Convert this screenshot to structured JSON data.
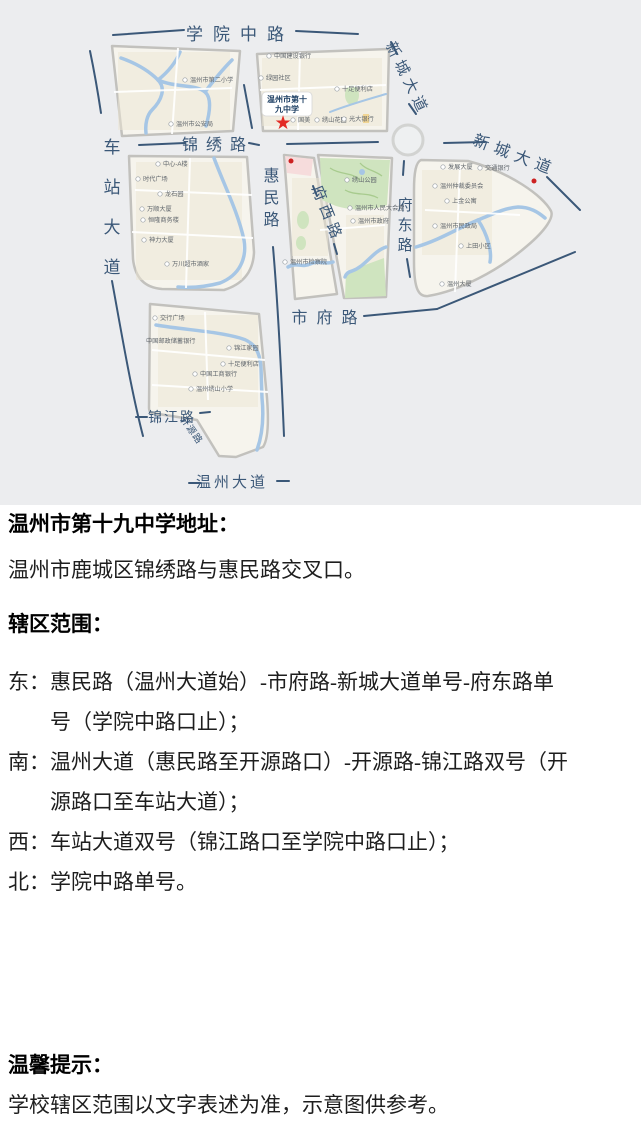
{
  "map": {
    "background": "#ecedef",
    "colors": {
      "block_fill": "#f6f4ed",
      "block_border": "#c2c1bd",
      "river": "#a6c6e5",
      "park": "#cfe4bf",
      "pink_area": "#f6dcdc",
      "road_label": "#3b5878",
      "star": "#e32a24"
    },
    "roads": {
      "xueyuan": "学院中路",
      "xincheng": "新城大道",
      "chezhan": "车站大道",
      "jinxiu": "锦绣路",
      "huimin": "惠民路",
      "fuxi": "府西路",
      "fudong": "府东路",
      "shifu": "市府路",
      "jinjiang": "锦江路",
      "kaiyuan": "开源路",
      "wenzhoudadao": "温州大道"
    },
    "school": {
      "name": "温州市第十九中学",
      "line1": "温州市第十",
      "line2": "九中学"
    },
    "pois": [
      {
        "name": "中国建设银行"
      },
      {
        "name": "绿园社区"
      },
      {
        "name": "十足便利店"
      },
      {
        "name": "国美"
      },
      {
        "name": "绣山花园"
      },
      {
        "name": "光大银行"
      },
      {
        "name": "温州市第二小学"
      },
      {
        "name": "温州市公安局"
      },
      {
        "name": "中心-A楼"
      },
      {
        "name": "时代广场"
      },
      {
        "name": "龙石园"
      },
      {
        "name": "万顺大厦"
      },
      {
        "name": "恒隆商务楼"
      },
      {
        "name": "神力大厦"
      },
      {
        "name": "万川超市酒家"
      },
      {
        "name": "温州市检察院"
      },
      {
        "name": "绣山公园"
      },
      {
        "name": "温州市人民大会堂"
      },
      {
        "name": "温州市政府"
      },
      {
        "name": "发展大厦"
      },
      {
        "name": "交通银行"
      },
      {
        "name": "温州仲裁委员会"
      },
      {
        "name": "上金公寓"
      },
      {
        "name": "温州市民政局"
      },
      {
        "name": "上田小区"
      },
      {
        "name": "温州大厦"
      },
      {
        "name": "交行广场"
      },
      {
        "name": "中国邮政储蓄银行"
      },
      {
        "name": "中国工商银行"
      },
      {
        "name": "温州绣山小学"
      },
      {
        "name": "锦江家园"
      },
      {
        "name": "十足便利店"
      }
    ]
  },
  "content": {
    "address_heading": "温州市第十九中学地址：",
    "address": "温州市鹿城区锦绣路与惠民路交叉口。",
    "district_heading": "辖区范围：",
    "boundaries": [
      {
        "label": "东：",
        "text": "惠民路（温州大道始）-市府路-新城大道单号-府东路单号（学院中路口止）；"
      },
      {
        "label": "南：",
        "text": "温州大道（惠民路至开源路口）-开源路-锦江路双号（开源路口至车站大道）；"
      },
      {
        "label": "西：",
        "text": "车站大道双号（锦江路口至学院中路口止）；"
      },
      {
        "label": "北：",
        "text": "学院中路单号。"
      }
    ],
    "tips_heading": "温馨提示：",
    "tips": "学校辖区范围以文字表述为准，示意图供参考。"
  }
}
